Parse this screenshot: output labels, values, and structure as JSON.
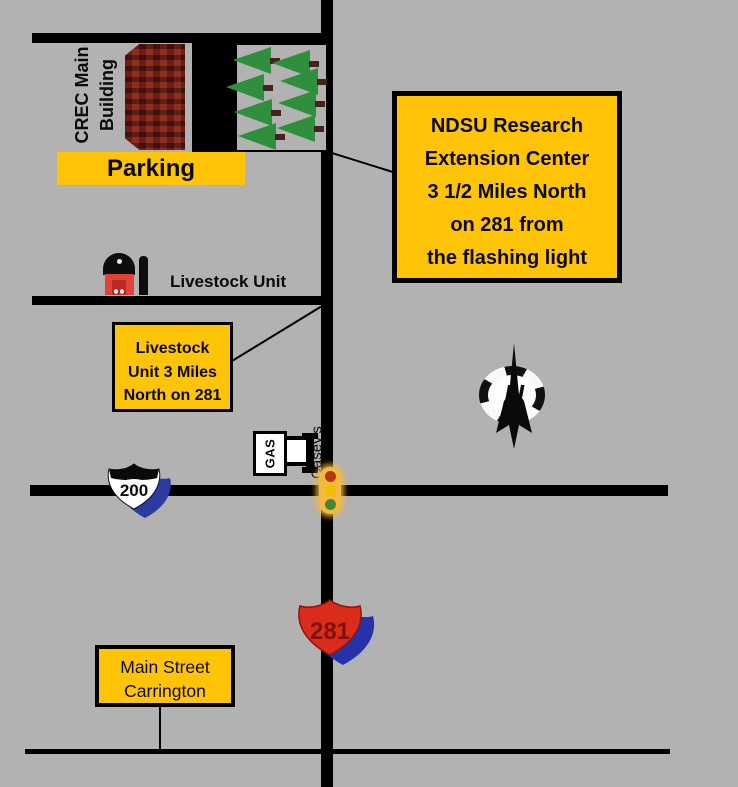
{
  "colors": {
    "background": "#b2b2b2",
    "road": "#000000",
    "callout_yellow": "#ffc408",
    "tree_green": "#2f8f3c",
    "building_red": "#7e2318",
    "barn_red": "#e2423a",
    "shield_blue": "#2c3ba0",
    "shield_red": "#da2b1b",
    "traffic_red": "#bb3311",
    "traffic_yellow": "#f0c000",
    "traffic_green": "#448833"
  },
  "crec": {
    "line1": "CREC Main",
    "line2": "Building"
  },
  "parking": {
    "label": "Parking"
  },
  "livestock": {
    "label": "Livestock Unit",
    "callout": {
      "line1": "Livestock",
      "line2": "Unit 3 Miles",
      "line3": "North on 281"
    }
  },
  "ndsu_callout": {
    "line1": "NDSU Research",
    "line2": "Extension Center",
    "line3": "3 1/2 Miles North",
    "line4": "on 281 from",
    "line5": "the flashing light"
  },
  "gas_station": {
    "sign": "GAS",
    "name": "Casey's"
  },
  "highways": {
    "route_200": "200",
    "route_281": "281"
  },
  "compass": {
    "north": "N"
  },
  "main_street_callout": {
    "line1": "Main Street",
    "line2": "Carrington"
  }
}
